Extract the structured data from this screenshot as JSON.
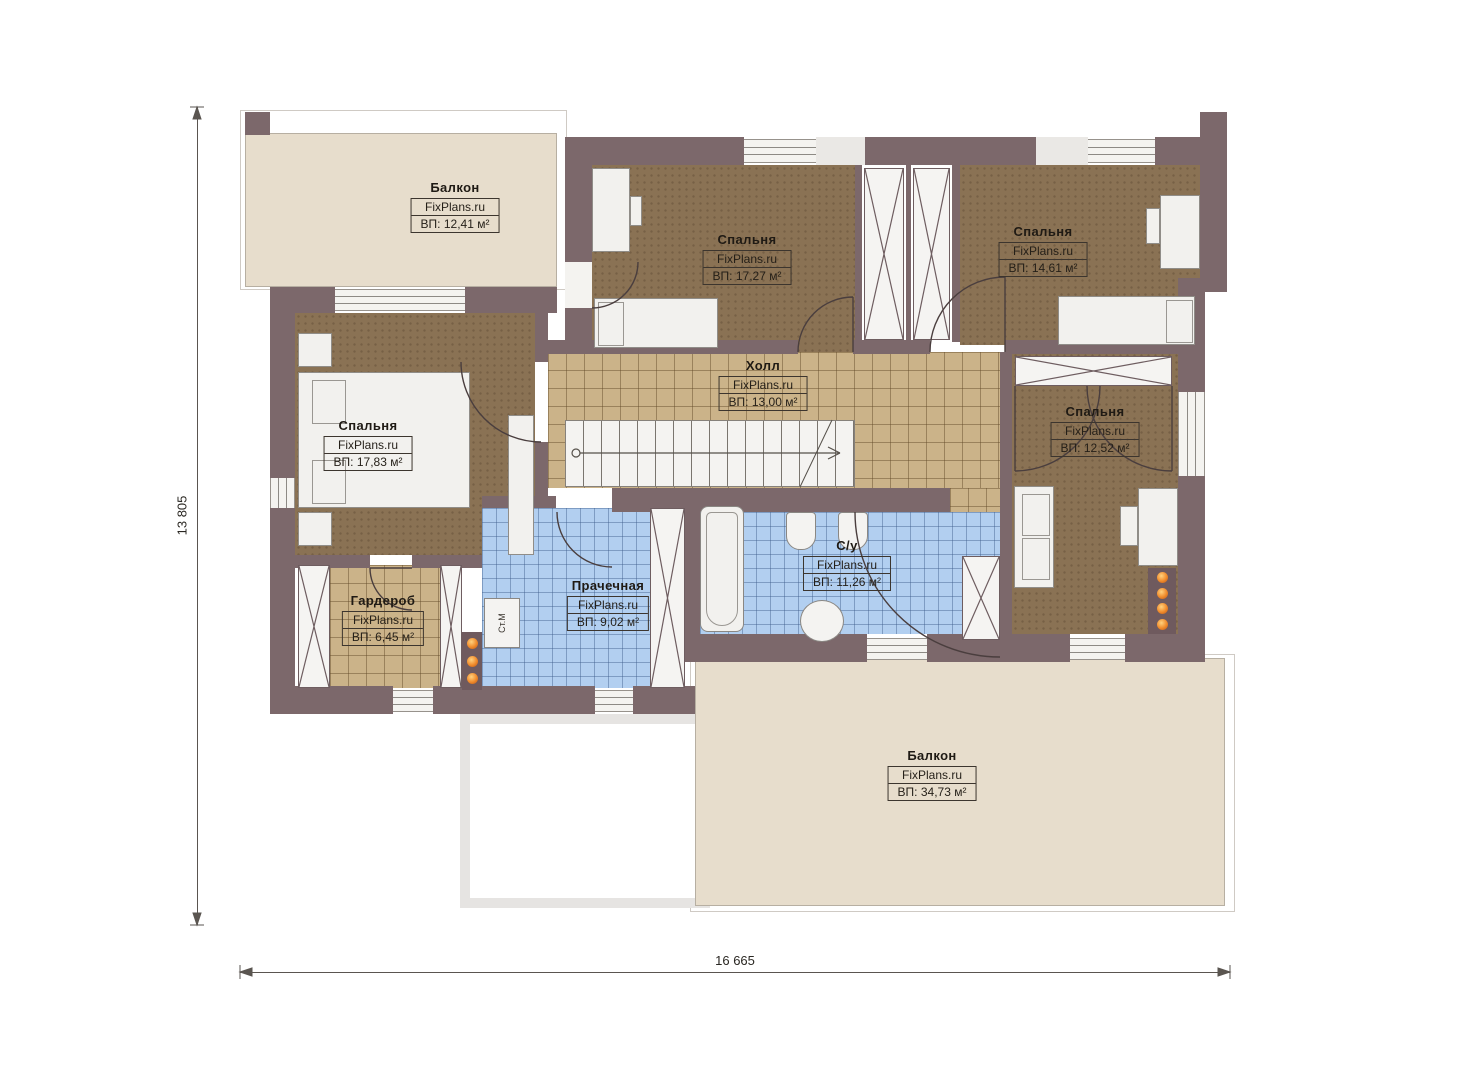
{
  "watermark": "FixPlans.ru",
  "dimensions": {
    "horizontal": "16 665",
    "vertical": "13 805"
  },
  "rooms": [
    {
      "name": "Балкон",
      "area": "ВП: 12,41 м²"
    },
    {
      "name": "Спальня",
      "area": "ВП: 17,27 м²"
    },
    {
      "name": "Спальня",
      "area": "ВП: 14,61 м²"
    },
    {
      "name": "Спальня",
      "area": "ВП: 17,83 м²"
    },
    {
      "name": "Холл",
      "area": "ВП: 13,00 м²"
    },
    {
      "name": "Спальня",
      "area": "ВП: 12,52 м²"
    },
    {
      "name": "Гардероб",
      "area": "ВП: 6,45 м²"
    },
    {
      "name": "Прачечная",
      "area": "ВП: 9,02 м²"
    },
    {
      "name": "С/у",
      "area": "ВП: 11,26 м²"
    },
    {
      "name": "Балкон",
      "area": "ВП: 34,73 м²"
    }
  ],
  "labels": {
    "washing_machine": "Ст.М"
  },
  "colors": {
    "wall": "#7c686b",
    "bedroom_floor": "#8a7254",
    "tile_tan": "#cbb389",
    "tile_blue": "#b2cff0",
    "balcony": "#e7ddcc",
    "accent_dot": "#f08a2a"
  }
}
